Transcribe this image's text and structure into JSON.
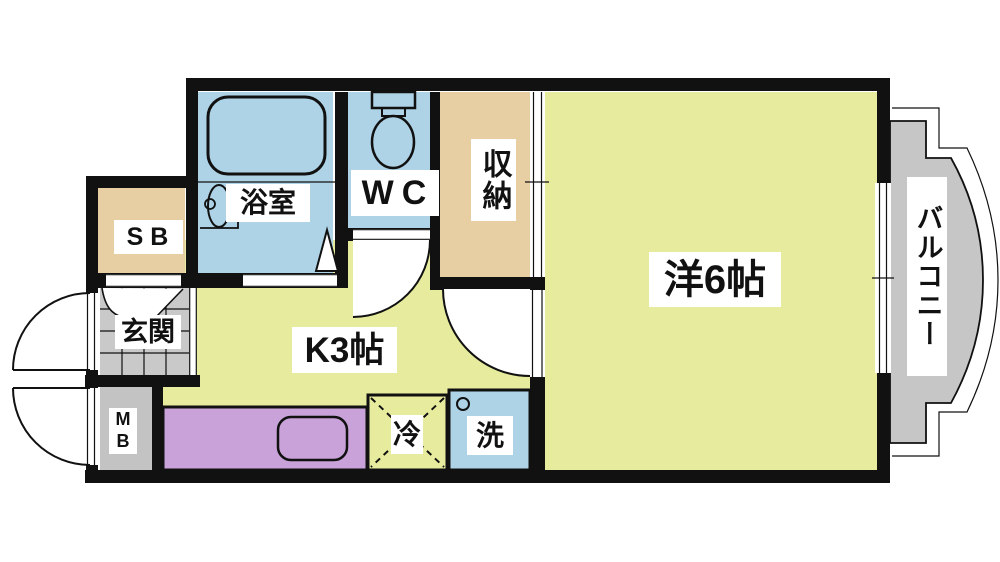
{
  "colors": {
    "wall": "#111111",
    "floor_yellow": "#e7eb9d",
    "wet_area_blue": "#aed3e6",
    "storage_tan": "#e8cfa3",
    "tile_gray": "#c9c9c9",
    "meter_box_gray": "#c3c3c3",
    "balcony_gray": "#c6c6c6",
    "counter_purple": "#c9a2d9",
    "label_background": "#ffffff"
  },
  "rooms": {
    "bathroom": {
      "label": "浴室"
    },
    "toilet": {
      "label": "WC"
    },
    "closet": {
      "label": "収納"
    },
    "western_room": {
      "label": "洋6帖"
    },
    "balcony": {
      "label": "バルコニー"
    },
    "shoe_box": {
      "label": "SB"
    },
    "entrance": {
      "label": "玄関"
    },
    "kitchen": {
      "label": "K3帖"
    },
    "meter_box": {
      "label": "MB"
    },
    "refrigerator": {
      "label": "冷"
    },
    "washing_machine": {
      "label": "洗"
    }
  }
}
